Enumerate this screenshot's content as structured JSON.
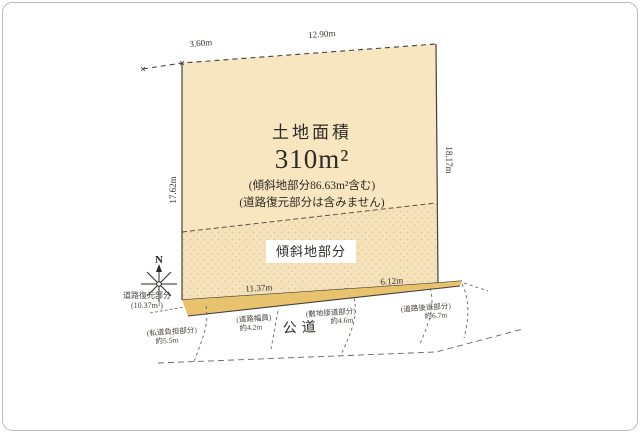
{
  "diagram": {
    "title_block": {
      "label": "土地面積",
      "area": "310m²",
      "note1": "(傾斜地部分86.63m²含む)",
      "note2": "(道路復元部分は含みません)"
    },
    "slope_label": "傾斜地部分",
    "compass": {
      "label": "N"
    },
    "road_restoration": {
      "line1": "道路復元部分",
      "line2": "(10.37m²)"
    },
    "dimensions": {
      "top_left": "3.60m",
      "top": "12.90m",
      "left": "17.62m",
      "right": "18.17m",
      "bottom_left": "11.37m",
      "bottom_right": "6.12m"
    },
    "road": {
      "name": "公道",
      "labels": [
        {
          "line1": "(私道負担部分)",
          "line2": "約5.5m"
        },
        {
          "line1": "(道路幅員)",
          "line2": "約4.2m"
        },
        {
          "line1": "(敷地接道部分)",
          "line2": "約4.6m"
        },
        {
          "line1": "(道路後退部分)",
          "line2": "約6.7m"
        }
      ]
    },
    "colors": {
      "parcel": "#f7e6c0",
      "restoration_strip": "#e9c26e",
      "line": "#3a3a3a"
    }
  }
}
